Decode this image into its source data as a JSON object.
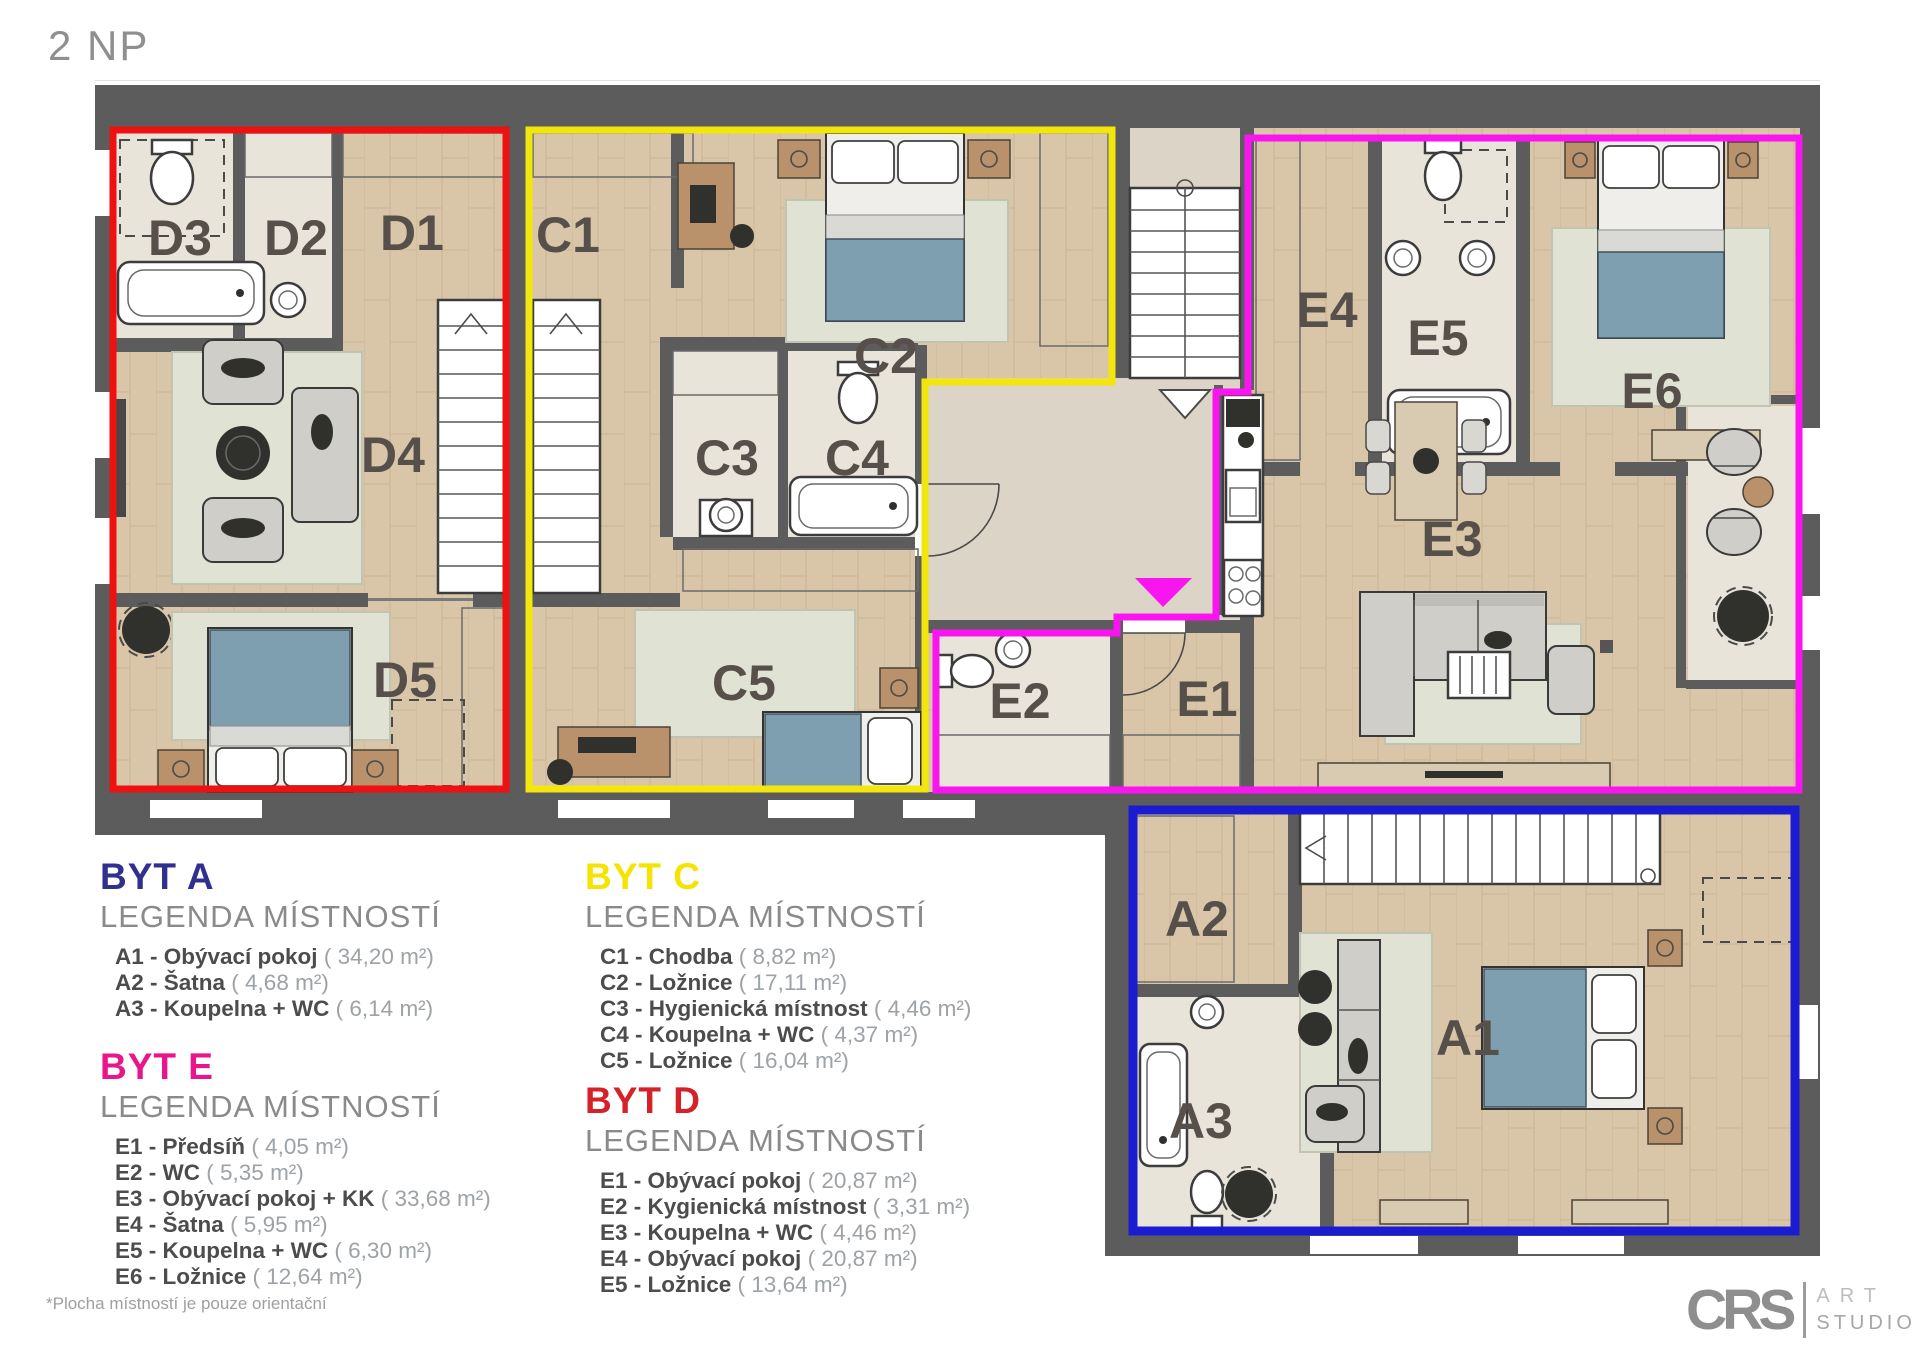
{
  "page": {
    "title": "2 NP",
    "footnote": "*Plocha místností je pouze orientační"
  },
  "logo": {
    "brand": "CRS",
    "word1": "ART",
    "word2": "STUDIO"
  },
  "plan": {
    "labels": {
      "d1": "D1",
      "d2": "D2",
      "d3": "D3",
      "d4": "D4",
      "d5": "D5",
      "c1": "C1",
      "c2": "C2",
      "c3": "C3",
      "c4": "C4",
      "c5": "C5",
      "e1": "E1",
      "e2": "E2",
      "e3": "E3",
      "e4": "E4",
      "e5": "E5",
      "e6": "E6",
      "a1": "A1",
      "a2": "A2",
      "a3": "A3"
    },
    "outline_colors": {
      "byt_d": "#ee1111",
      "byt_c": "#f2e60d",
      "byt_e": "#f915f0",
      "byt_a": "#1b1bd0",
      "entry_marker": "#f915f0"
    }
  },
  "legends": [
    {
      "id": "byt-a",
      "title": "BYT A",
      "color": "#32308e",
      "subtitle": "LEGENDA MÍSTNOSTÍ",
      "rooms": [
        {
          "label": "A1 - Obývací pokoj",
          "area": "( 34,20 m²)"
        },
        {
          "label": "A2 - Šatna",
          "area": "( 4,68 m²)"
        },
        {
          "label": "A3 - Koupelna + WC",
          "area": "( 6,14 m²)"
        }
      ]
    },
    {
      "id": "byt-c",
      "title": "BYT C",
      "color": "#f5e400",
      "subtitle": "LEGENDA MÍSTNOSTÍ",
      "rooms": [
        {
          "label": "C1 - Chodba",
          "area": "( 8,82 m²)"
        },
        {
          "label": "C2 - Ložnice",
          "area": "( 17,11 m²)"
        },
        {
          "label": "C3 - Hygienická místnost",
          "area": "( 4,46 m²)"
        },
        {
          "label": "C4 - Koupelna + WC",
          "area": "( 4,37 m²)"
        },
        {
          "label": "C5 - Ložnice",
          "area": "( 16,04 m²)"
        }
      ]
    },
    {
      "id": "byt-e",
      "title": "BYT E",
      "color": "#e8158b",
      "subtitle": "LEGENDA MÍSTNOSTÍ",
      "rooms": [
        {
          "label": "E1 - Předsíň",
          "area": "( 4,05 m²)"
        },
        {
          "label": "E2 - WC",
          "area": "( 5,35 m²)"
        },
        {
          "label": "E3 - Obývací pokoj + KK",
          "area": "( 33,68 m²)"
        },
        {
          "label": "E4 - Šatna",
          "area": "( 5,95 m²)"
        },
        {
          "label": "E5 - Koupelna + WC",
          "area": "( 6,30 m²)"
        },
        {
          "label": "E6 - Ložnice",
          "area": "( 12,64 m²)"
        }
      ]
    },
    {
      "id": "byt-d",
      "title": "BYT D",
      "color": "#d62128",
      "subtitle": "LEGENDA MÍSTNOSTÍ",
      "rooms": [
        {
          "label": "E1 - Obývací pokoj",
          "area": "( 20,87 m²)"
        },
        {
          "label": "E2 - Kygienická místnost",
          "area": "( 3,31 m²)"
        },
        {
          "label": "E3 - Koupelna + WC",
          "area": "( 4,46 m²)"
        },
        {
          "label": "E4 - Obývací pokoj",
          "area": "( 20,87 m²)"
        },
        {
          "label": "E5 - Ložnice",
          "area": "( 13,64 m²)"
        }
      ]
    }
  ]
}
